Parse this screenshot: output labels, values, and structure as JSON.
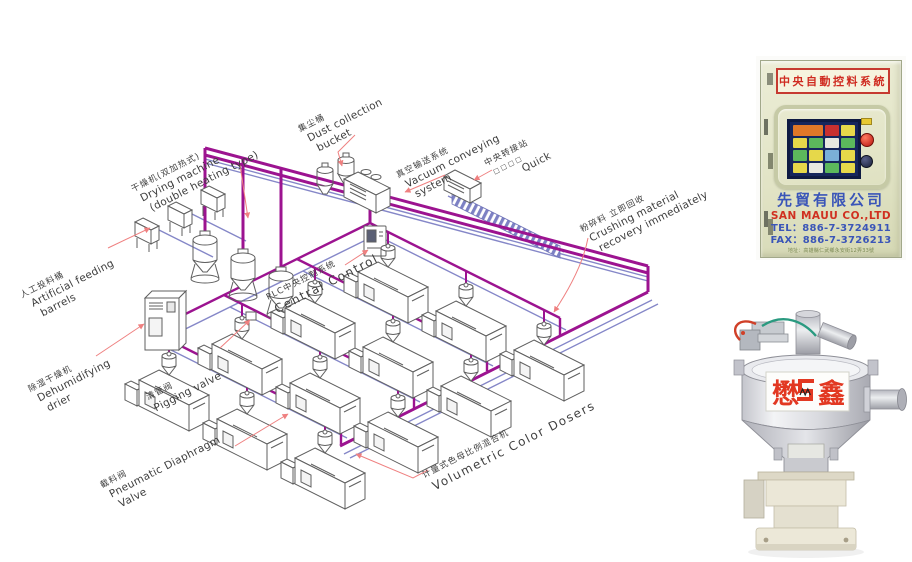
{
  "diagram": {
    "labels": {
      "artificial_feeding": {
        "zh": "人工投料桶",
        "en1": "Artificial feeding",
        "en2": "barrels"
      },
      "drying_machine": {
        "zh": "干燥机(双加热式)",
        "en1": "Drying machine",
        "en2": "(double heating type)"
      },
      "dust_collection": {
        "zh": "集尘桶",
        "en1": "Dust collection",
        "en2": "bucket"
      },
      "vacuum_conveying": {
        "zh": "真空输送系统",
        "en1": "Vacuum conveying",
        "en2": "system"
      },
      "central_transfer": {
        "zh": "中央转接站",
        "sub": "□□□□"
      },
      "quick": {
        "en": "Quick"
      },
      "plc": {
        "zh": "PLC中央控制系统",
        "en": "Central Control"
      },
      "dehumidifying": {
        "zh": "除湿干燥机",
        "en1": "Dehumidifying",
        "en2": "drier"
      },
      "pigging_valve": {
        "zh": "清管阀",
        "en": "Pigging valve"
      },
      "crushing": {
        "zh": "粉碎料 立即回收",
        "en1": "Crushing material",
        "en2": "recovery immediately"
      },
      "cutoff_valve": {
        "zh": "截料阀",
        "en1": "Pneumatic Diaphragm",
        "en2": "Valve"
      },
      "volumetric": {
        "zh": "计量式色母比例混合机",
        "en": "Volumetric Color Dosers"
      }
    },
    "colors": {
      "pipe_magenta": "#9c1390",
      "pipe_blue": "#8587c8",
      "leader_red": "#ef8080",
      "outline_gray": "#5f5f5f"
    }
  },
  "cabinet": {
    "header": "中央自動控料系統",
    "company_zh": "先貿有限公司",
    "company_en": "SAN MAUU CO.,LTD",
    "tel": "TEL：886-7-3724911",
    "fax": "FAX：886-7-3726213",
    "address": "地址：高雄縣仁武鄉永安街12弄33號",
    "accent_red": "#cf2a20",
    "accent_blue": "#3a55b8"
  },
  "hopper": {
    "brand_left": "懋",
    "brand_right": "鑫",
    "brand_color": "#e23822"
  }
}
